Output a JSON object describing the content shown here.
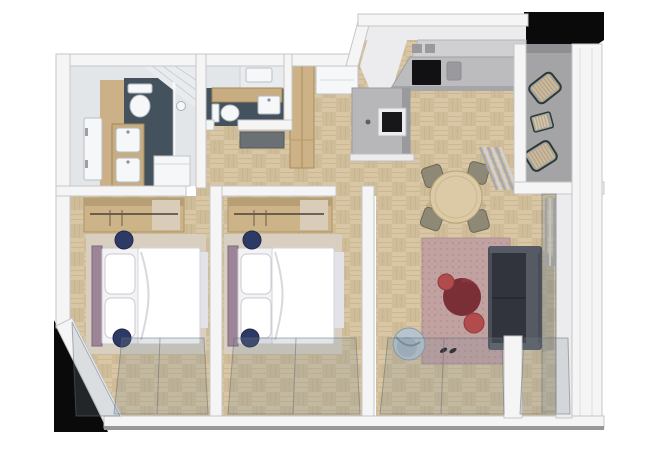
{
  "scene": {
    "title": "3D axonometric floor plan of a two-bedroom apartment",
    "view": "top-down cutaway render"
  },
  "colors": {
    "background": "#ffffff",
    "backdrop_black": "#0a0a0a",
    "wall": "#f5f5f6",
    "wall_edge": "#c6c6ca",
    "wall_face": "#ececee",
    "wall_outer_line": "#98989b",
    "parquet_light": "#d8c6a4",
    "parquet_dark": "#cfbc98",
    "parquet_line": "#c2ad85",
    "bathroom_tile": "#44525e",
    "bathroom_wall": "#e3e6e9",
    "bathroom_wood_floor": "#ccb188",
    "ceiling_plank": "#e9ecef",
    "vanity_wood": "#c9ad82",
    "fixture_white": "#f6f7f8",
    "fixture_edge": "#b5bbc1",
    "cabinet_wood": "#cdb187",
    "doormat_gray": "#6b7075",
    "kitchen_counter": "#bcbcbf",
    "kitchen_counter_front": "#a6a6aa",
    "kitchen_shelf": "#d0d0d3",
    "cooktop_black": "#111114",
    "partition_gray": "#b7b7ba",
    "partition_shade": "#9a9a9e",
    "tv_frame": "#ececee",
    "tv_black": "#17171a",
    "dining_table_wood": "#dccaa6",
    "dining_table_edge": "#b6a175",
    "dining_chair": "#8e8877",
    "rug_mauve": "#c2a1a1",
    "rug_dot": "#ad8c8c",
    "sofa_base": "#4a4e58",
    "sofa_seat": "#31343c",
    "sofa_arm": "#565a64",
    "ottoman_dark_red": "#7a2e35",
    "ottoman_hilite": "#8a3640",
    "pouf_red": "#b24c4c",
    "armchair_blue": "#b7c4cf",
    "armchair_inner": "#a4b4c1",
    "bed_white": "#f3f3f5",
    "bed_duvet": "#ffffff",
    "bed_shade": "#e2e2e8",
    "headboard_mauve": "#9d8496",
    "nightstand_navy": "#2e3a66",
    "bedroom_rug": "#d8cfc0",
    "wardrobe_wood": "#cdb488",
    "wardrobe_top": "#b89e74",
    "wardrobe_cloth": "#d9cdb9",
    "balcony_floor": "#a4a4a7",
    "chair_slat_wood": "#d3b88c",
    "table_slat_wood": "#d9c49c",
    "chair_frame_dark": "#2c3b31",
    "curtain_dark": "#a9a9ad",
    "curtain_light": "#d2d2d6",
    "glass_tint": "rgba(125,140,150,0.22)",
    "glass_edge": "rgba(96,106,116,0.5)",
    "shadow": "rgba(110,110,115,0.3)"
  },
  "rooms": [
    {
      "name": "Main bathroom",
      "furniture": [
        "toilet",
        "double-sink vanity",
        "walk-in shower",
        "storage cabinet",
        "door"
      ]
    },
    {
      "name": "Second bathroom",
      "furniture": [
        "toilet",
        "sink vanity",
        "skylight"
      ]
    },
    {
      "name": "Entrance hallway",
      "furniture": [
        "entry door",
        "doormat",
        "tall wood cabinet"
      ]
    },
    {
      "name": "Kitchen",
      "furniture": [
        "counter",
        "cooktop",
        "sink",
        "media partition wall"
      ]
    },
    {
      "name": "Dining area",
      "furniture": [
        "round dining table",
        "four dining chairs"
      ]
    },
    {
      "name": "Living room",
      "furniture": [
        "area rug",
        "sofa",
        "round ottoman",
        "two poufs",
        "armchair",
        "curtains"
      ]
    },
    {
      "name": "Left bedroom",
      "furniture": [
        "double bed",
        "headboard",
        "two nightstands",
        "open wardrobe",
        "rug"
      ]
    },
    {
      "name": "Middle bedroom",
      "furniture": [
        "double bed",
        "headboard",
        "two nightstands",
        "open wardrobe",
        "rug"
      ]
    },
    {
      "name": "Balcony",
      "furniture": [
        "two slatted chairs",
        "slatted side table"
      ]
    }
  ]
}
